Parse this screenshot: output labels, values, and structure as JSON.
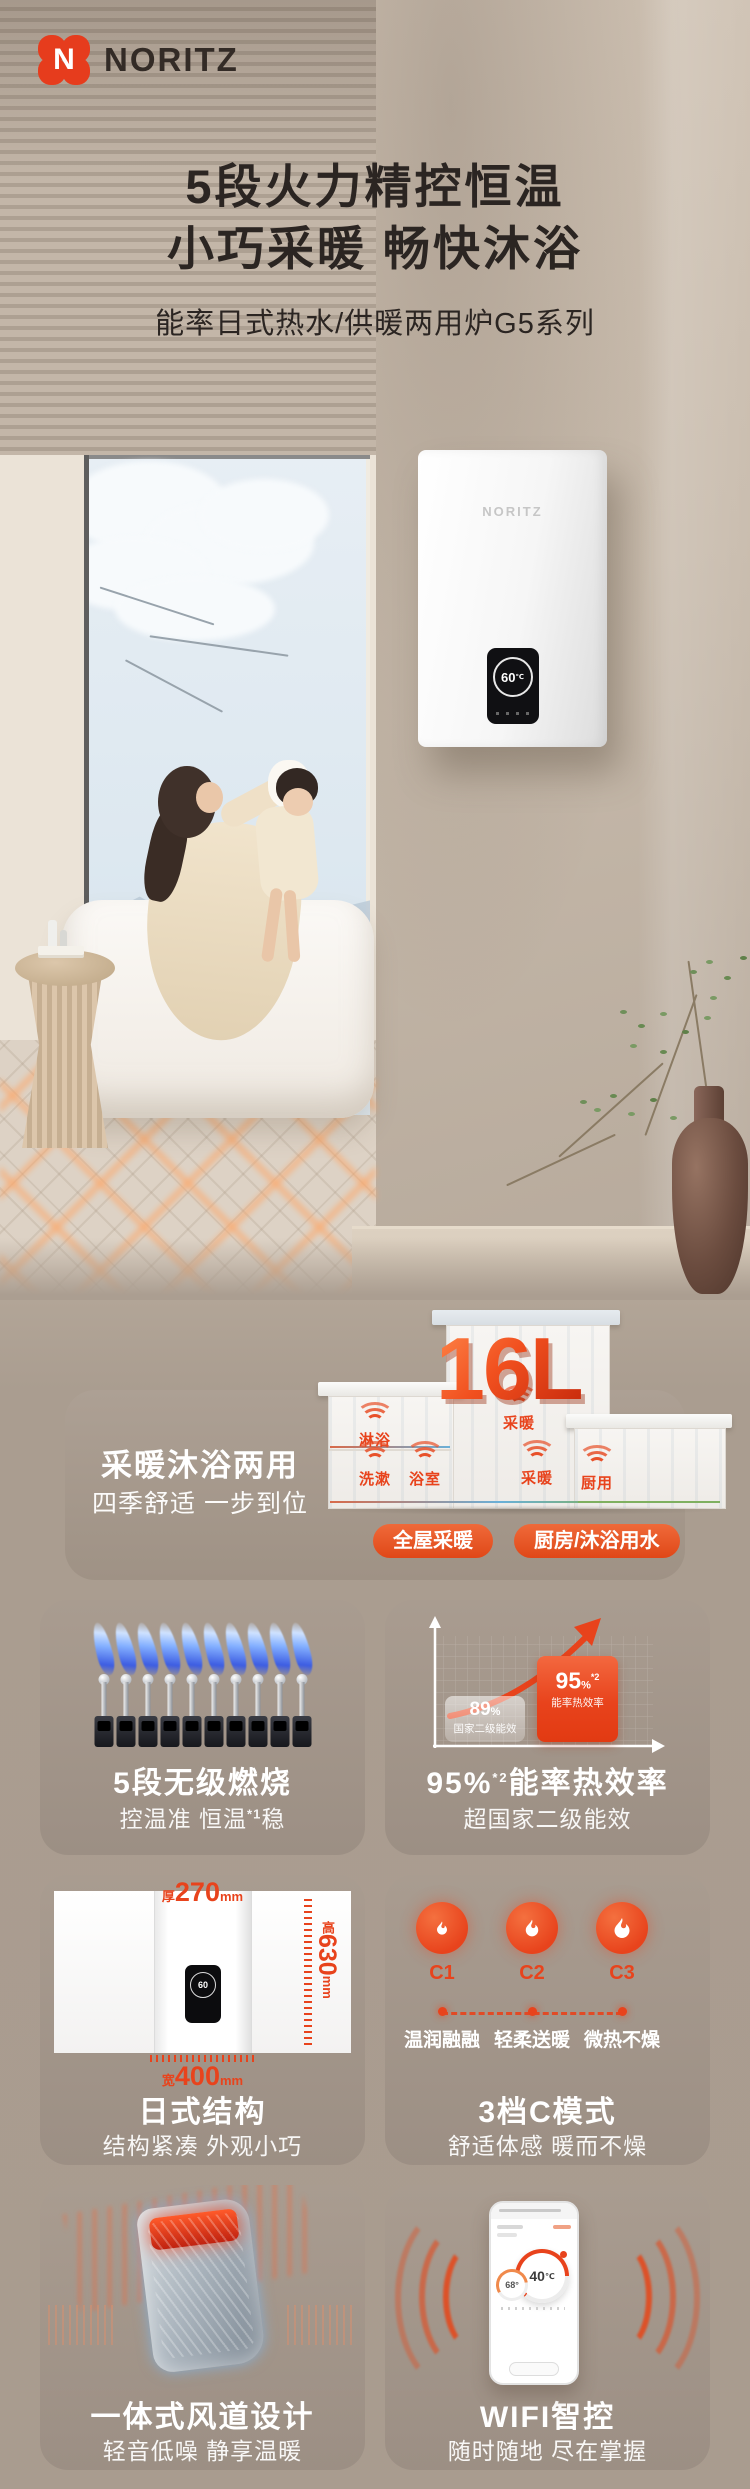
{
  "brand": {
    "name": "NORITZ",
    "mark_letter": "N"
  },
  "hero": {
    "title_line1": "5段火力精控恒温",
    "title_line2": "小巧采暖 畅快沐浴",
    "subtitle": "能率日式热水/供暖两用炉G5系列",
    "heater_brand": "NORITZ",
    "heater_temp": "60",
    "heater_temp_unit": "℃"
  },
  "capacity": {
    "value": "16L",
    "heading": "采暖沐浴两用",
    "subheading": "四季舒适 一步到位",
    "rooms": [
      "淋浴",
      "采暖",
      "洗漱",
      "浴室",
      "采暖",
      "厨用"
    ],
    "pill_left": "全屋采暖",
    "pill_right": "厨房/沐浴用水"
  },
  "features": {
    "burn": {
      "title": "5段无级燃烧",
      "sub_prefix": "控温准 恒温",
      "sub_sup": "*1",
      "sub_suffix": "稳"
    },
    "eff": {
      "title_value": "95%",
      "title_sup": "*2",
      "title_suffix": "能率热效率",
      "subtitle": "超国家二级能效",
      "low_value": "89",
      "low_unit": "%",
      "low_label": "国家二级能效",
      "high_value": "95",
      "high_unit": "%",
      "high_sup": "*2",
      "high_label": "能率热效率"
    },
    "structure": {
      "title": "日式结构",
      "subtitle": "结构紧凑 外观小巧",
      "depth_prefix": "厚",
      "depth_value": "270",
      "depth_unit": "mm",
      "height_prefix": "高",
      "height_value": "630",
      "height_unit": "mm",
      "width_prefix": "宽",
      "width_value": "400",
      "width_unit": "mm",
      "display_temp": "60"
    },
    "cmode": {
      "title": "3档C模式",
      "subtitle": "舒适体感 暖而不燥",
      "modes": [
        {
          "id": "C1",
          "label": "温润融融"
        },
        {
          "id": "C2",
          "label": "轻柔送暖"
        },
        {
          "id": "C3",
          "label": "微热不燥"
        }
      ]
    },
    "duct": {
      "title": "一体式风道设计",
      "subtitle": "轻音低噪 静享温暖"
    },
    "wifi": {
      "title": "WIFI智控",
      "subtitle": "随时随地 尽在掌握",
      "phone_temp": "40",
      "phone_temp_unit": "℃",
      "phone_temp2": "68",
      "phone_temp2_unit": "°"
    }
  },
  "colors": {
    "accent": "#e8431c",
    "page_bg": "#aa9d90",
    "card_bg": "#a2958a",
    "headline": "#2b2522"
  }
}
